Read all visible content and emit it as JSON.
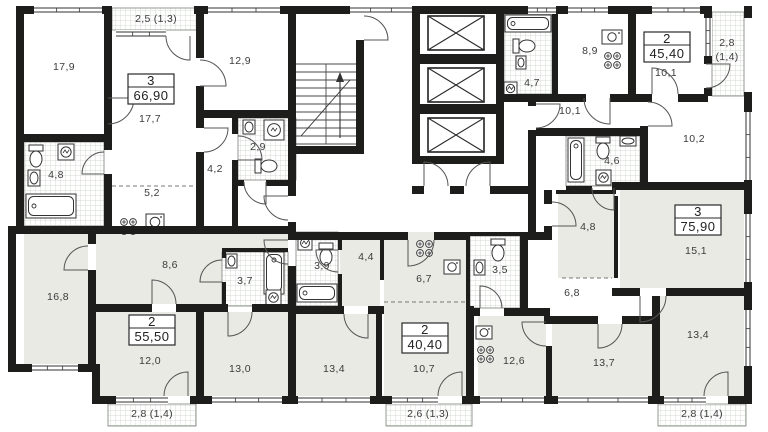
{
  "plan": {
    "units_note": "m2",
    "apartments": [
      {
        "rooms_count": "3",
        "total_area": "66,90",
        "box_cx": 151,
        "box_cy": 89
      },
      {
        "rooms_count": "2",
        "total_area": "45,40",
        "box_cx": 667,
        "box_cy": 47
      },
      {
        "rooms_count": "3",
        "total_area": "75,90",
        "box_cx": 698,
        "box_cy": 220
      },
      {
        "rooms_count": "2",
        "total_area": "55,50",
        "box_cx": 152,
        "box_cy": 330
      },
      {
        "rooms_count": "2",
        "total_area": "40,40",
        "box_cx": 425,
        "box_cy": 338
      }
    ],
    "room_areas": [
      {
        "label": "17,9",
        "x": 64,
        "y": 70
      },
      {
        "label": "17,7",
        "x": 150,
        "y": 122
      },
      {
        "label": "12,9",
        "x": 240,
        "y": 64
      },
      {
        "label": "4,8",
        "x": 56,
        "y": 178
      },
      {
        "label": "2,9",
        "x": 258,
        "y": 150
      },
      {
        "label": "4,2",
        "x": 215,
        "y": 172
      },
      {
        "label": "5,2",
        "x": 152,
        "y": 196
      },
      {
        "label": "8,6",
        "x": 170,
        "y": 268
      },
      {
        "label": "3,7",
        "x": 245,
        "y": 284
      },
      {
        "label": "16,8",
        "x": 58,
        "y": 300
      },
      {
        "label": "12,0",
        "x": 150,
        "y": 364
      },
      {
        "label": "13,0",
        "x": 240,
        "y": 372
      },
      {
        "label": "3,9",
        "x": 322,
        "y": 269
      },
      {
        "label": "4,4",
        "x": 366,
        "y": 260
      },
      {
        "label": "6,7",
        "x": 424,
        "y": 282
      },
      {
        "label": "3,5",
        "x": 500,
        "y": 273
      },
      {
        "label": "13,4",
        "x": 334,
        "y": 372
      },
      {
        "label": "10,7",
        "x": 424,
        "y": 372
      },
      {
        "label": "8,9",
        "x": 590,
        "y": 54
      },
      {
        "label": "4,7",
        "x": 532,
        "y": 86
      },
      {
        "label": "10,1",
        "x": 666,
        "y": 76
      },
      {
        "label": "10,1",
        "x": 570,
        "y": 114
      },
      {
        "label": "10,2",
        "x": 694,
        "y": 142
      },
      {
        "label": "4,6",
        "x": 612,
        "y": 164
      },
      {
        "label": "4,8",
        "x": 588,
        "y": 230
      },
      {
        "label": "15,1",
        "x": 696,
        "y": 254
      },
      {
        "label": "6,8",
        "x": 572,
        "y": 296
      },
      {
        "label": "12,6",
        "x": 514,
        "y": 364
      },
      {
        "label": "13,7",
        "x": 604,
        "y": 366
      },
      {
        "label": "13,4",
        "x": 698,
        "y": 338
      }
    ],
    "balcony_areas": [
      {
        "label": "2,5 (1,3)",
        "x": 156,
        "y": 22
      },
      {
        "label": "2,8",
        "x": 727,
        "y": 46
      },
      {
        "label": "(1,4)",
        "x": 727,
        "y": 60
      },
      {
        "label": "2,8 (1,4)",
        "x": 152,
        "y": 417
      },
      {
        "label": "2,6 (1,3)",
        "x": 428,
        "y": 417
      },
      {
        "label": "2,8 (1,4)",
        "x": 702,
        "y": 417
      }
    ]
  },
  "colors": {
    "wall": "#1d1d1b",
    "room_gray": "#e8eae3",
    "tile_line": "#c9cfc6",
    "drawing_line": "#4a4a4a",
    "text": "#3c3c3c"
  }
}
